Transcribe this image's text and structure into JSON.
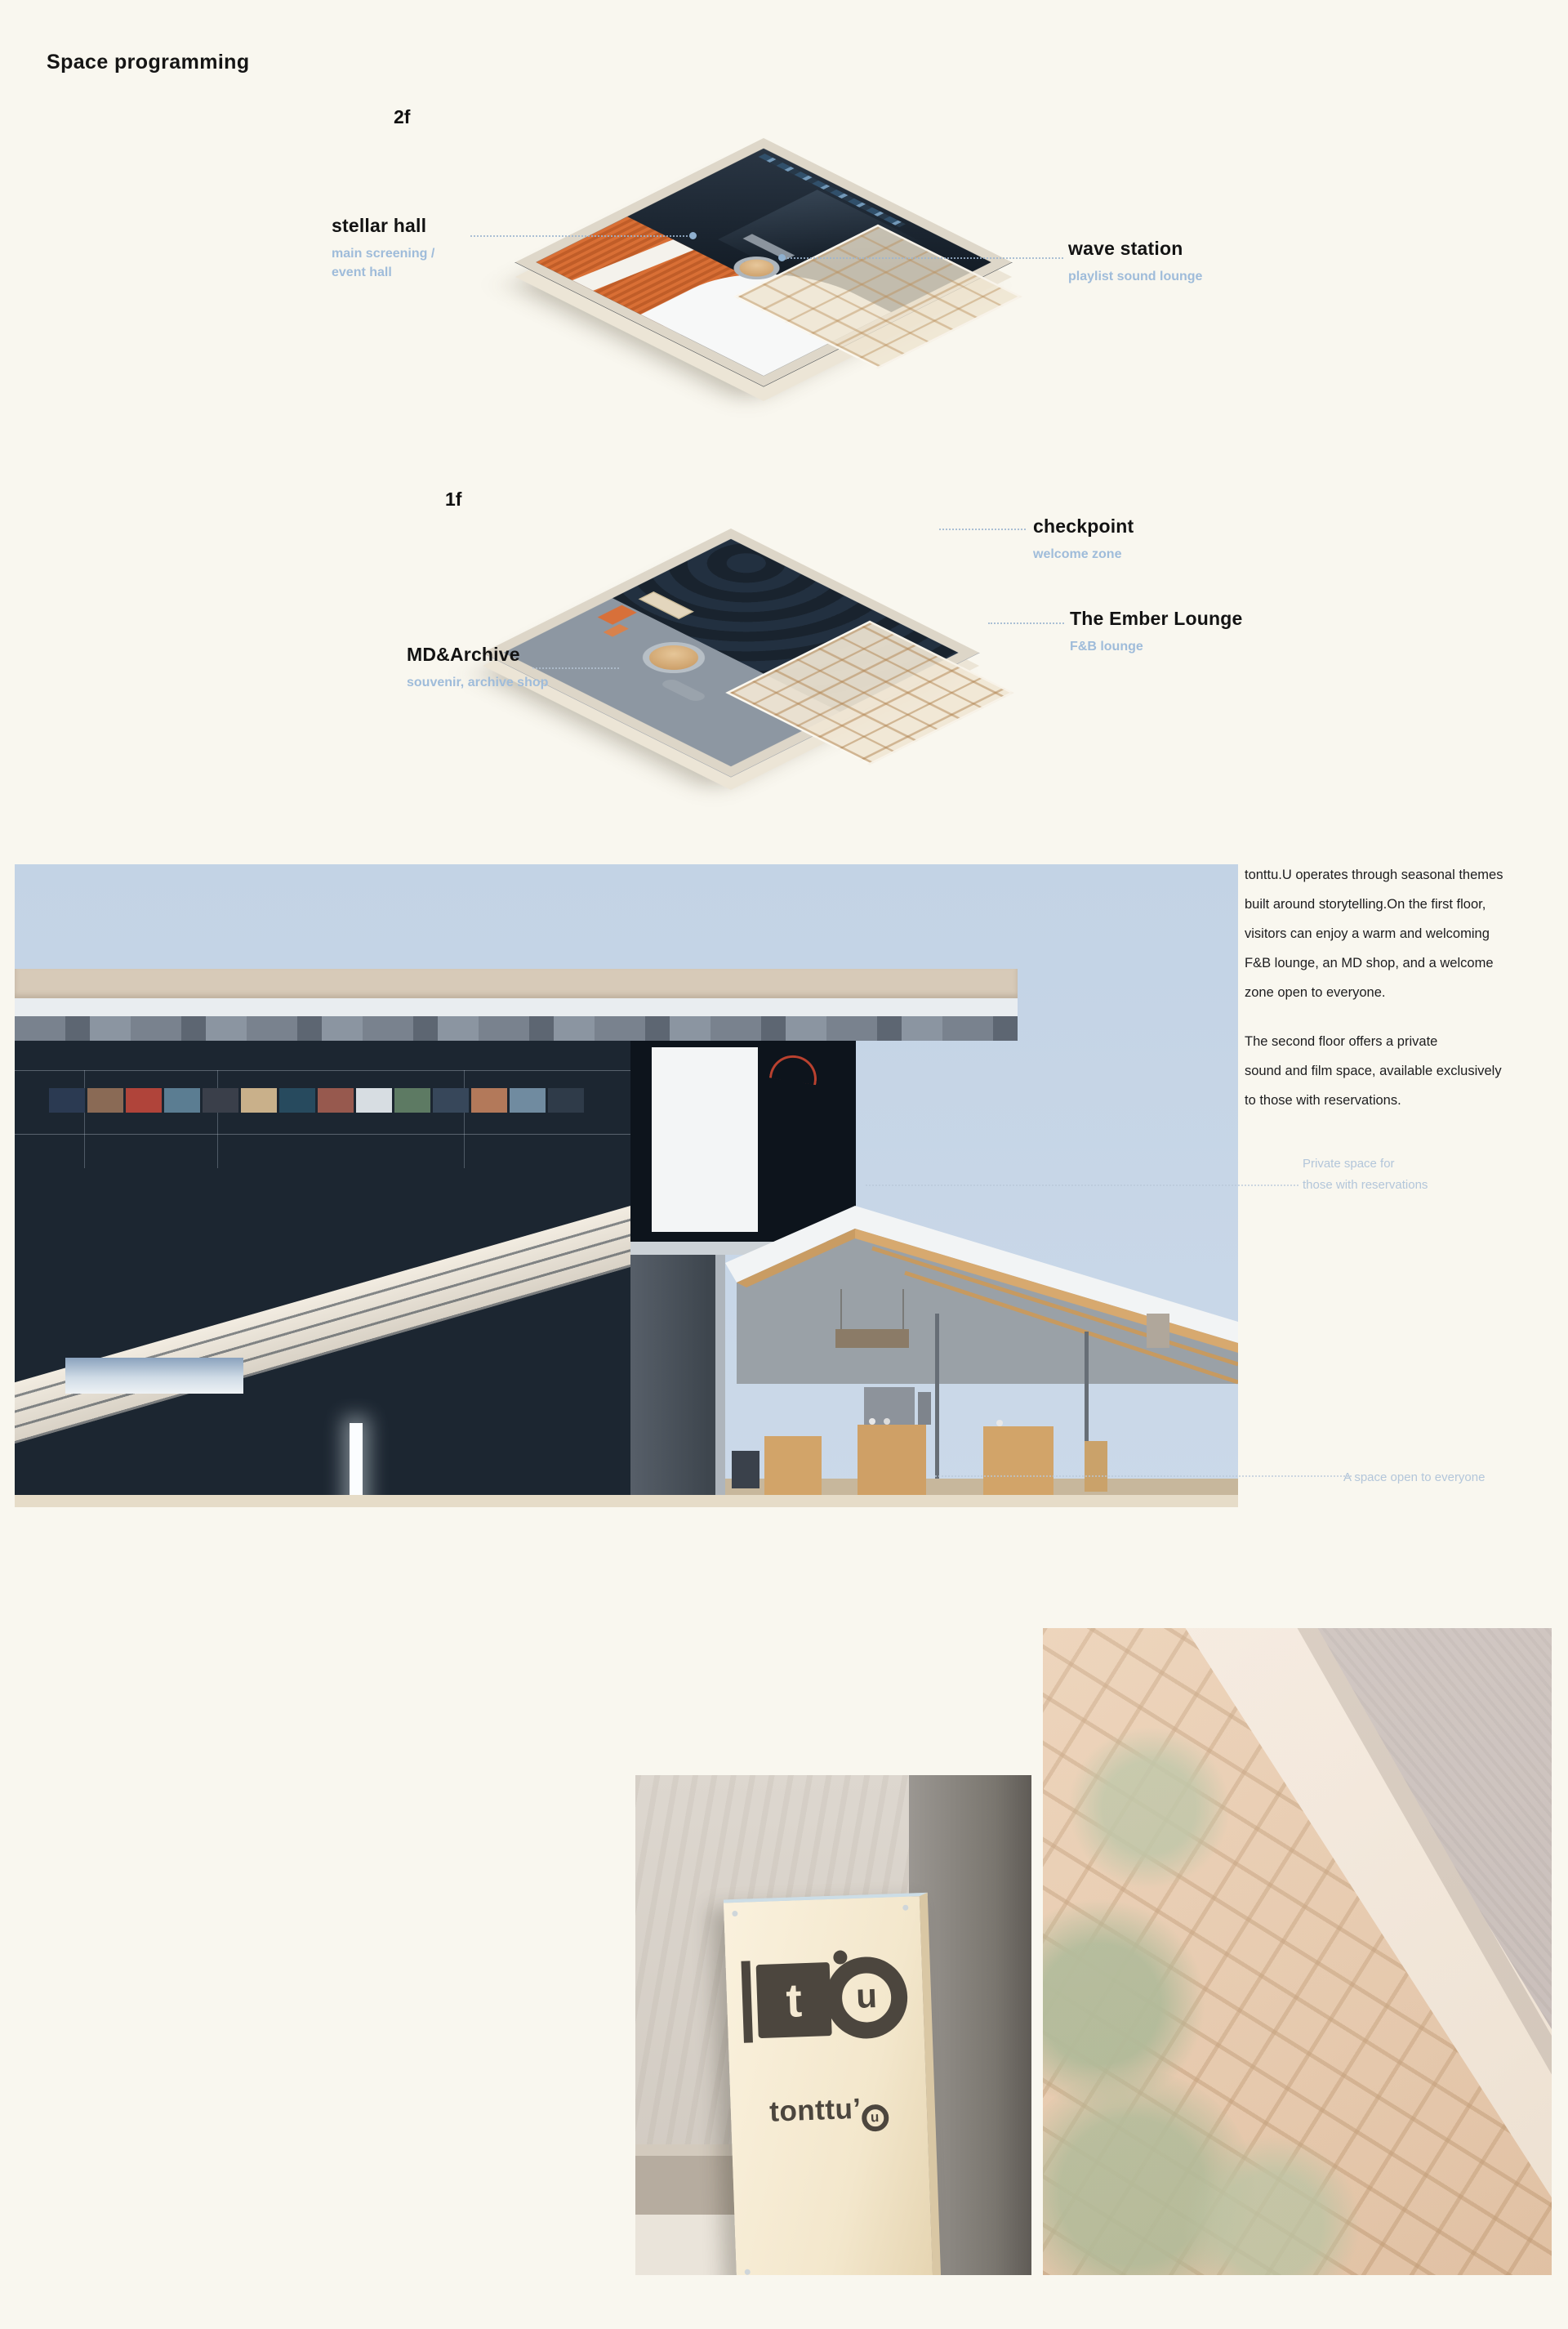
{
  "page": {
    "title": "Space programming"
  },
  "floors": [
    {
      "label": "2f",
      "rooms": [
        {
          "name": "stellar hall",
          "desc": [
            "main screening /",
            "event hall"
          ]
        },
        {
          "name": "wave station",
          "desc": [
            "playlist sound lounge"
          ]
        }
      ]
    },
    {
      "label": "1f",
      "rooms": [
        {
          "name": "checkpoint",
          "desc": [
            "welcome zone"
          ]
        },
        {
          "name": "The Ember Lounge",
          "desc": [
            "F&B lounge"
          ]
        },
        {
          "name": "MD&Archive",
          "desc": [
            "souvenir, archive shop"
          ]
        }
      ]
    }
  ],
  "copy": {
    "p1_lines": [
      "tonttu.U operates through seasonal themes",
      "built around storytelling.On the first floor,",
      "visitors can enjoy a warm and welcoming",
      "F&B lounge, an MD shop, and a welcome",
      "zone open to everyone."
    ],
    "p2_lines": [
      "The second floor offers a private",
      "sound and film space, available exclusively",
      "to those with reservations."
    ]
  },
  "annotations": {
    "private_line1": "Private space for",
    "private_line2": "those with reservations",
    "open": "A space open to everyone"
  },
  "brand": {
    "mark_t": "t",
    "mark_u": "u",
    "wordmark_prefix": "tonttu’",
    "wordmark_u": "u"
  },
  "colors": {
    "background": "#f9f7ef",
    "label_accent": "#9fbcda",
    "annotation": "#b3c6da",
    "roof_orange": "#d96f35",
    "interior_navy": "#1c2631",
    "sky": "#c8d7e7",
    "concrete_band": "#d7cab8",
    "wood": "#d2a469",
    "sign_panel": "#f5ead3",
    "logo_gray": "#4c463e"
  },
  "section_render": {
    "poster_colors": [
      "#2b3a52",
      "#8a6a55",
      "#b0443a",
      "#5b7d92",
      "#3a3f4a",
      "#c9b08a",
      "#274a5e",
      "#97594e",
      "#d7dde2",
      "#5d7a63",
      "#37475a",
      "#b3795a",
      "#708ba0",
      "#2f3b49"
    ]
  }
}
